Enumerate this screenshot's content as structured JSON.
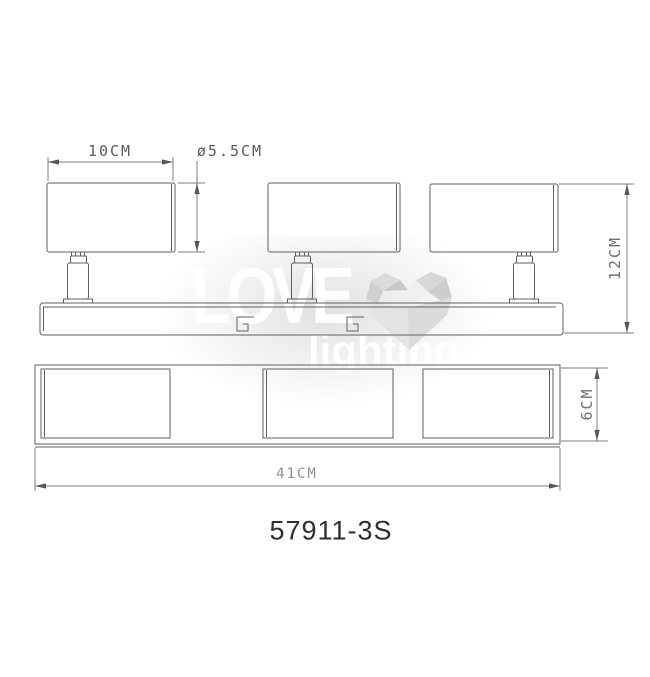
{
  "watermark": {
    "line1": "LOVE",
    "line2": "lighting",
    "heart_icon": "faceted-heart"
  },
  "dimensions": {
    "head_width": "10CM",
    "head_diameter": "ø5.5CM",
    "overall_height": "12CM",
    "base_depth": "6CM",
    "overall_length": "41CM"
  },
  "model_number": "57911-3S",
  "colors": {
    "object_line": "#5f5f5f",
    "dimension_line": "#7a7a7a",
    "dim_text": "#5a5a5a",
    "dim_text_light": "#8e8e8e",
    "model_text": "#2e2e2e",
    "watermark_text": "#ffffff",
    "watermark_heart": "#d6d6d6"
  }
}
